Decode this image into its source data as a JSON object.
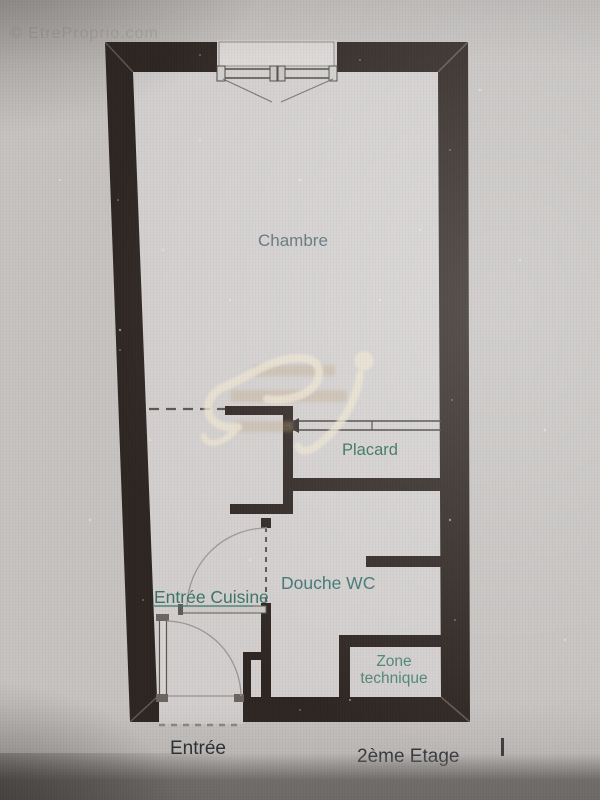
{
  "watermark": {
    "copyright": {
      "text": "© EtreProprio.com",
      "color": "#b4b1ae"
    }
  },
  "plan": {
    "labels": {
      "chambre": {
        "text": "Chambre",
        "color": "#5c7078"
      },
      "placard": {
        "text": "Placard",
        "color": "#2f6e53"
      },
      "douche_wc": {
        "text": "Douche WC",
        "color": "#3f7570"
      },
      "entree_cuisine": {
        "text": "Entrée Cuisine",
        "color": "#3c7468"
      },
      "zone_technique": {
        "line1": "Zone",
        "line2": "technique",
        "color": "#4f857a"
      }
    },
    "footer": {
      "entrance": {
        "text": "Entrée",
        "color": "#2b2f33"
      },
      "floor": {
        "text": "2ème Etage",
        "color": "#33373c"
      }
    }
  },
  "colors": {
    "wall": "#2e2622",
    "paper": "#d2cfce",
    "background": "#c6c3c1",
    "thin_line": "#57534f",
    "arc_line": "#9b9792",
    "logo_cream": "#ece3d0",
    "logo_tan": "#b99b72",
    "cursor_mark": "#3a3d40"
  }
}
